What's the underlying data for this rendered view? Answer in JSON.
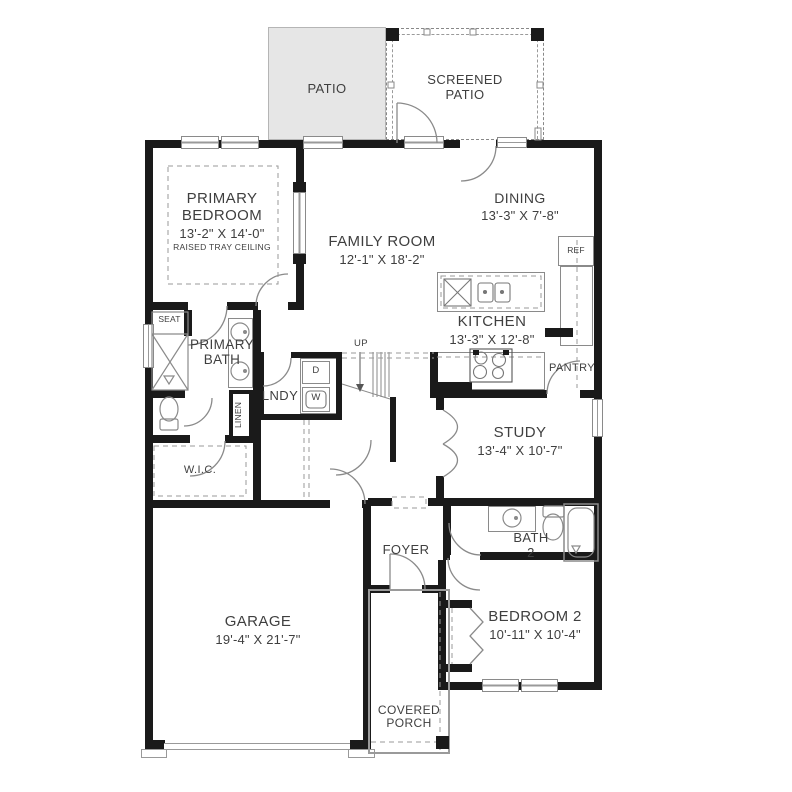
{
  "plan_title": "First floor plan",
  "colors": {
    "wall": "#1a1a1a",
    "patio_fill": "#e6e6e6",
    "fixture_line": "#8a8a8a",
    "text": "#3f3f3f"
  },
  "rooms": {
    "patio": {
      "name": "PATIO"
    },
    "screened_patio": {
      "name": "SCREENED PATIO"
    },
    "primary_bedroom": {
      "name": "PRIMARY BEDROOM",
      "dims": "13'-2\" X 14'-0\"",
      "note": "RAISED TRAY CEILING"
    },
    "family_room": {
      "name": "FAMILY ROOM",
      "dims": "12'-1\" X 18'-2\""
    },
    "dining": {
      "name": "DINING",
      "dims": "13'-3\" X 7'-8\""
    },
    "kitchen": {
      "name": "KITCHEN",
      "dims": "13'-3\" X 12'-8\""
    },
    "pantry": {
      "name": "PANTRY"
    },
    "study": {
      "name": "STUDY",
      "dims": "13'-4\" X 10'-7\""
    },
    "primary_bath": {
      "name": "PRIMARY BATH"
    },
    "laundry": {
      "name": "LNDY"
    },
    "wic": {
      "name": "W.I.C."
    },
    "foyer": {
      "name": "FOYER"
    },
    "bath2": {
      "name": "BATH 2"
    },
    "bedroom2": {
      "name": "BEDROOM 2",
      "dims": "10'-11\" X 10'-4\""
    },
    "garage": {
      "name": "GARAGE",
      "dims": "19'-4\" X 21'-7\""
    },
    "covered_porch": {
      "name": "COVERED PORCH"
    }
  },
  "fixtures": {
    "ref": "REF",
    "seat": "SEAT",
    "linen": "LINEN",
    "dryer": "D",
    "washer": "W",
    "stairs_up": "UP"
  }
}
